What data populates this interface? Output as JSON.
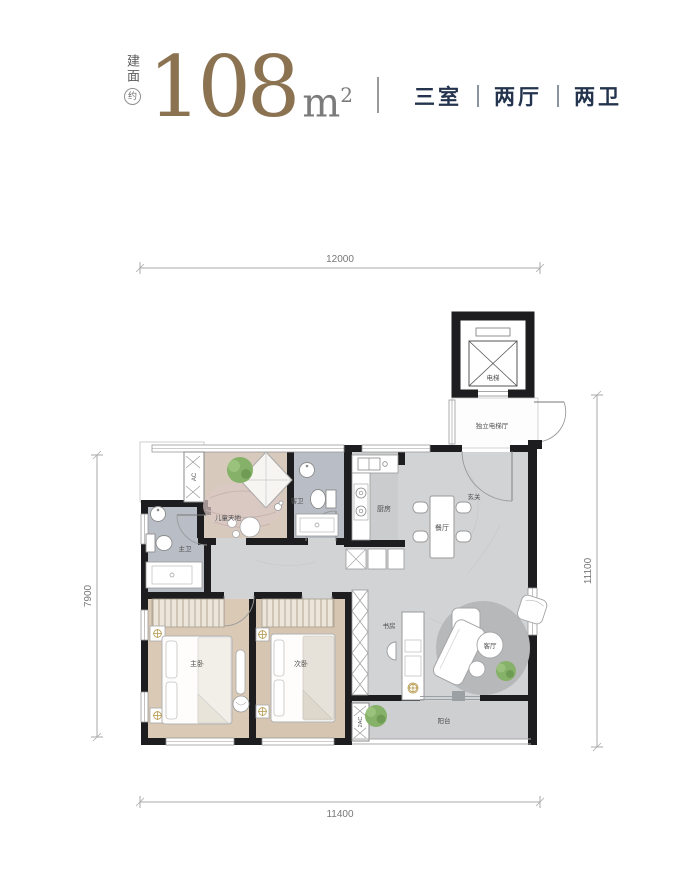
{
  "header": {
    "area_label": "建面",
    "approx_label": "约",
    "area_value": "108",
    "area_unit": "m",
    "area_unit_sup": "2",
    "specs": {
      "rooms": "三室",
      "halls": "两厅",
      "baths": "两卫"
    }
  },
  "dimensions": {
    "top": "12000",
    "bottom": "11400",
    "left": "7900",
    "right": "11100"
  },
  "rooms": {
    "elevator": "电梯",
    "elevator_hall": "独立电梯厅",
    "foyer": "玄关",
    "dining": "餐厅",
    "kitchen": "厨房",
    "guest_bath": "客卫",
    "kids_zone": "儿童天地",
    "master_bath": "主卫",
    "master_bedroom": "主卧",
    "second_bedroom": "次卧",
    "study": "书房",
    "living": "客厅",
    "balcony": "阳台"
  },
  "equipment": {
    "ac": "AC",
    "ac2": "2AC"
  },
  "colors": {
    "accent_bronze": "#8b7352",
    "navy": "#24344e",
    "wall": "#1d1d1f",
    "marble_floor": "#d2d3d5",
    "bedroom_floor": "#d9c9b5",
    "bath_floor": "#b9bec6",
    "kids_floor": "#d7cabc",
    "plant_green": "#86b168"
  }
}
